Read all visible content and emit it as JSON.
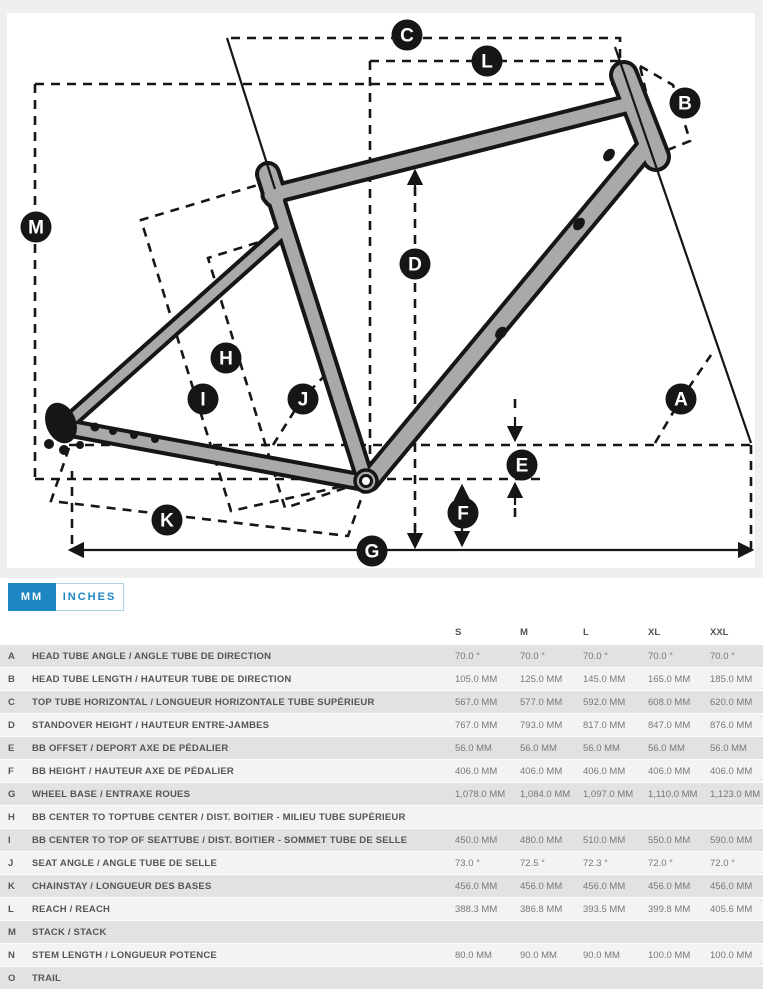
{
  "colors": {
    "accent": "#1d87c4",
    "page_gray": "#efefef",
    "row_dark": "#e2e2e2",
    "row_light": "#f3f3f3",
    "frame_gray": "#a9a9a9",
    "line_black": "#161616"
  },
  "tabs": [
    {
      "label": "MM",
      "active": true
    },
    {
      "label": "INCHES",
      "active": false
    }
  ],
  "diagram": {
    "markers": [
      {
        "letter": "C",
        "x": 404,
        "y": 32
      },
      {
        "letter": "L",
        "x": 484,
        "y": 58
      },
      {
        "letter": "B",
        "x": 682,
        "y": 100
      },
      {
        "letter": "M",
        "x": 33,
        "y": 224
      },
      {
        "letter": "D",
        "x": 412,
        "y": 261
      },
      {
        "letter": "H",
        "x": 223,
        "y": 355
      },
      {
        "letter": "I",
        "x": 200,
        "y": 396
      },
      {
        "letter": "J",
        "x": 300,
        "y": 396
      },
      {
        "letter": "A",
        "x": 678,
        "y": 396
      },
      {
        "letter": "E",
        "x": 519,
        "y": 462
      },
      {
        "letter": "F",
        "x": 460,
        "y": 510
      },
      {
        "letter": "K",
        "x": 164,
        "y": 517
      },
      {
        "letter": "G",
        "x": 369,
        "y": 548
      }
    ]
  },
  "table": {
    "columns": [
      "S",
      "M",
      "L",
      "XL",
      "XXL"
    ],
    "rows": [
      {
        "letter": "A",
        "label": "HEAD TUBE ANGLE / ANGLE TUBE DE DIRECTION",
        "values": [
          "70.0 °",
          "70.0 °",
          "70.0 °",
          "70.0 °",
          "70.0 °"
        ]
      },
      {
        "letter": "B",
        "label": "HEAD TUBE LENGTH / HAUTEUR TUBE DE DIRECTION",
        "values": [
          "105.0 MM",
          "125.0 MM",
          "145.0 MM",
          "165.0 MM",
          "185.0 MM"
        ]
      },
      {
        "letter": "C",
        "label": "TOP TUBE HORIZONTAL / LONGUEUR HORIZONTALE TUBE SUPÉRIEUR",
        "values": [
          "567.0 MM",
          "577.0 MM",
          "592.0 MM",
          "608.0 MM",
          "620.0 MM"
        ]
      },
      {
        "letter": "D",
        "label": "STANDOVER HEIGHT / HAUTEUR ENTRE-JAMBES",
        "values": [
          "767.0 MM",
          "793.0 MM",
          "817.0 MM",
          "847.0 MM",
          "876.0 MM"
        ]
      },
      {
        "letter": "E",
        "label": "BB OFFSET / DEPORT AXE DE PÉDALIER",
        "values": [
          "56.0 MM",
          "56.0 MM",
          "56.0 MM",
          "56.0 MM",
          "56.0 MM"
        ]
      },
      {
        "letter": "F",
        "label": "BB HEIGHT / HAUTEUR AXE DE PÉDALIER",
        "values": [
          "406.0 MM",
          "406.0 MM",
          "406.0 MM",
          "406.0 MM",
          "406.0 MM"
        ]
      },
      {
        "letter": "G",
        "label": "WHEEL BASE / ENTRAXE ROUES",
        "values": [
          "1,078.0 MM",
          "1,084.0 MM",
          "1,097.0 MM",
          "1,110.0 MM",
          "1,123.0 MM"
        ]
      },
      {
        "letter": "H",
        "label": "BB CENTER TO TOPTUBE CENTER / DIST. BOITIER - MILIEU TUBE SUPÉRIEUR",
        "values": [
          "",
          "",
          "",
          "",
          ""
        ]
      },
      {
        "letter": "I",
        "label": "BB CENTER TO TOP OF SEATTUBE / DIST. BOITIER - SOMMET TUBE DE SELLE",
        "values": [
          "450.0 MM",
          "480.0 MM",
          "510.0 MM",
          "550.0 MM",
          "590.0 MM"
        ]
      },
      {
        "letter": "J",
        "label": "SEAT ANGLE / ANGLE TUBE DE SELLE",
        "values": [
          "73.0 °",
          "72.5 °",
          "72.3 °",
          "72.0 °",
          "72.0 °"
        ]
      },
      {
        "letter": "K",
        "label": "CHAINSTAY / LONGUEUR DES BASES",
        "values": [
          "456.0 MM",
          "456.0 MM",
          "456.0 MM",
          "456.0 MM",
          "456.0 MM"
        ]
      },
      {
        "letter": "L",
        "label": "REACH / REACH",
        "values": [
          "388.3 MM",
          "386.8 MM",
          "393.5 MM",
          "399.8 MM",
          "405.6 MM"
        ]
      },
      {
        "letter": "M",
        "label": "STACK / STACK",
        "values": [
          "",
          "",
          "",
          "",
          ""
        ]
      },
      {
        "letter": "N",
        "label": "STEM LENGTH / LONGUEUR POTENCE",
        "values": [
          "80.0 MM",
          "90.0 MM",
          "90.0 MM",
          "100.0 MM",
          "100.0 MM"
        ]
      },
      {
        "letter": "O",
        "label": "TRAIL",
        "values": [
          "",
          "",
          "",
          "",
          ""
        ]
      }
    ]
  }
}
